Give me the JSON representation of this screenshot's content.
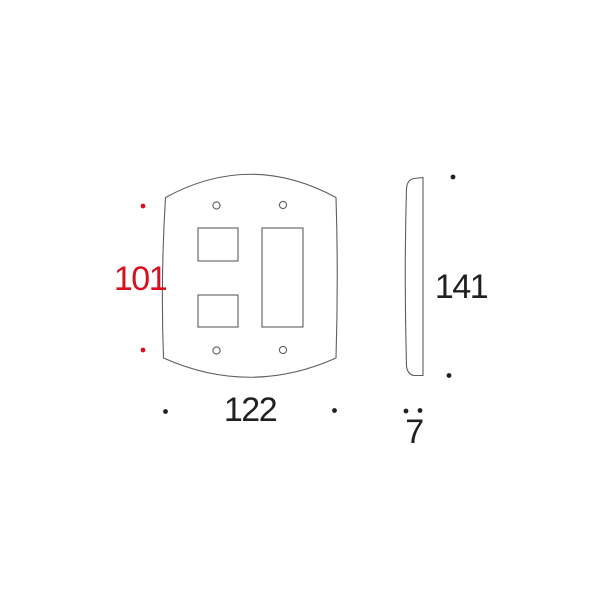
{
  "colors": {
    "accent_red": "#d70f1e",
    "line_gray": "#5e5e5e",
    "text_black": "#231f20",
    "background": "#ffffff"
  },
  "dimensions": {
    "mounting_hole_spacing": "101",
    "plate_width": "122",
    "plate_height": "141",
    "plate_thickness": "7"
  }
}
